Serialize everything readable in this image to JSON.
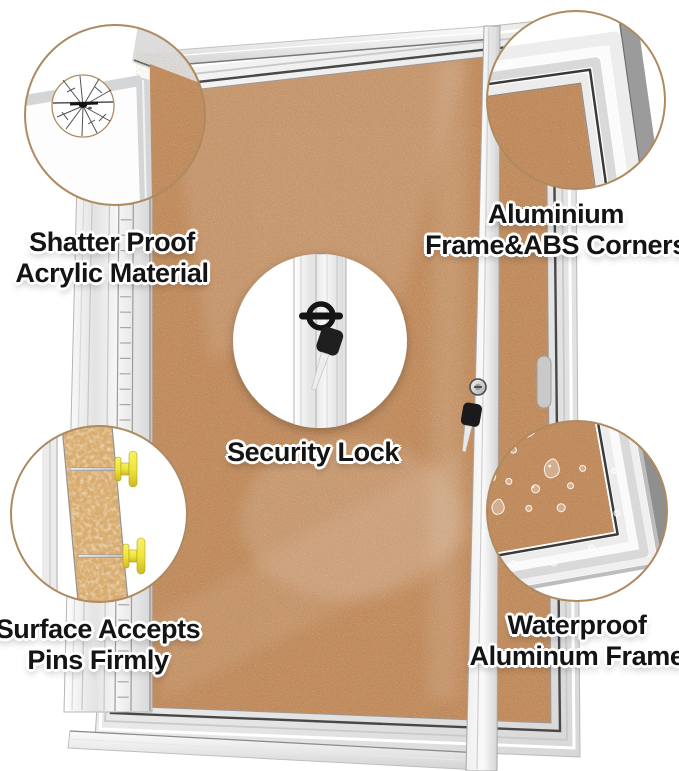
{
  "product": {
    "kind": "enclosed-cork-bulletin-board-feature-infographic"
  },
  "labels": {
    "shatter": {
      "line1": "Shatter Proof",
      "line2": "Acrylic Material"
    },
    "corners": {
      "line1": "Aluminium",
      "line2": "Frame&ABS Corners"
    },
    "lock": {
      "line1": "Security Lock"
    },
    "pins": {
      "line1": "Surface Accepts",
      "line2": "Pins Firmly"
    },
    "waterproof": {
      "line1": "Waterproof",
      "line2": "Aluminum Frame"
    }
  },
  "icons": {
    "shatter": "shattered-acrylic-icon",
    "corners": "frame-corner-icon",
    "lock": "lock-and-key-icon",
    "pins": "pushpins-in-cork-icon",
    "waterproof": "water-drops-icon"
  },
  "colors": {
    "cork": "#c08a5c",
    "cork_light": "#dcae72",
    "frame_light": "#f2f2f2",
    "frame_mid": "#d6d6d6",
    "frame_dark": "#8f8f8f",
    "groove": "#3f3f3f",
    "callout_border": "#ae8a60",
    "pin_yellow": "#efe53e",
    "key_black": "#1a1a1a",
    "label_text": "#141414",
    "label_outline": "#ffffff",
    "bg": "#ffffff"
  }
}
